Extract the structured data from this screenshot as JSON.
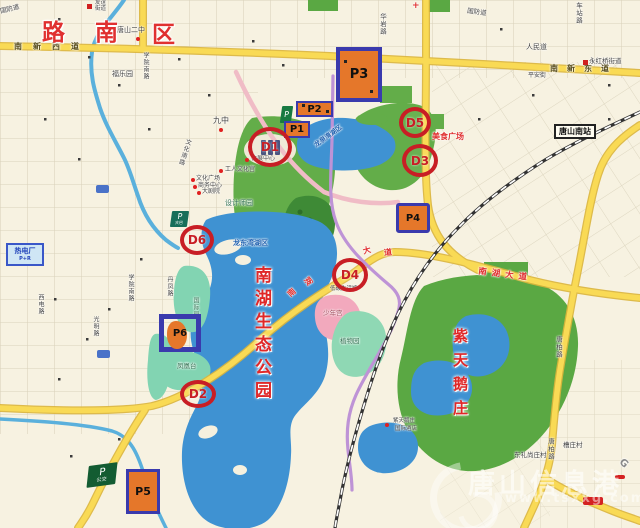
{
  "region": {
    "chars": [
      "路",
      "南",
      "区"
    ]
  },
  "roads": {
    "guofang": "国防道",
    "renmin": "人民道",
    "pingan": "平安街",
    "nanxin_west": "南新西道",
    "nanxin_east": "南新东道",
    "huayan": "华岩路",
    "chezhan": "车站路",
    "xueyuan_south": "学院南路",
    "danfeng": "丹凤路",
    "wenhua_south": "文化南路",
    "guangming": "光明路",
    "xidian": "西电路",
    "tangbai": "唐柏路",
    "nanhu_avenue": "南湖大道",
    "nanhu_chars": [
      "南",
      "湖",
      "大",
      "道"
    ],
    "g_label": "G"
  },
  "places": {
    "tangshan_no2": "唐山二中",
    "youyi_line1": "友谊",
    "youyi_line2": "街道",
    "yonghongqiao": "永红桥街道",
    "fuleyuan": "福乐园",
    "jiuzhong": "九中",
    "huizhan": "会展中心",
    "wenhuagong": "工人文化宫",
    "wenhua_sq": "文化广场",
    "shangwu": "商务中心",
    "theater": "大剧院",
    "designer_garden": "设计师园",
    "food_plaza": "美食广场",
    "fenghuangtai": "凤凰台",
    "intl_garden": "国际园",
    "youth_palace": "少年宫",
    "botanic_garden": "植物园",
    "lowcarbon_hall": "低碳生活馆",
    "hotel_line1": "紫天鹅庄",
    "hotel_line2": "国际酒店",
    "hospital_cross": "+"
  },
  "lakes": {
    "longdongwan": "龙东湾湖区",
    "longquanwan": "龙泉湾湖区"
  },
  "park_name": {
    "text": "南湖生态公园"
  },
  "swan_name": {
    "text": "紫天鹅庄"
  },
  "station": {
    "name": "唐山南站"
  },
  "villages": {
    "dongli": "东礼尚庄村",
    "caozhuang": "槽庄村"
  },
  "markers": {
    "p1": "P1",
    "p2": "P2",
    "p3": "P3",
    "p4": "P4",
    "p5": "P5",
    "p6": "P6",
    "d1": "D1",
    "d2": "D2",
    "d3": "D3",
    "d4": "D4",
    "d5": "D5",
    "d6": "D6",
    "p_small": "P",
    "p_daba_p": "P",
    "p_daba_txt": "大巴",
    "p_bus_p": "P",
    "p_bus_txt": "公交",
    "plant_name": "热电厂",
    "plant_code": "P+R"
  },
  "watermark": {
    "title": "唐山信息港",
    "url": "www.tsxxg.com"
  },
  "colors": {
    "d_marker_red": "#c81e25",
    "p_border_blue": "#3a3aad",
    "p_fill_orange": "#e5772a",
    "road_yellow": "#f9da55",
    "water_blue": "#3f92d2",
    "park_green": "#5aa843",
    "label_red": "#e03030"
  }
}
